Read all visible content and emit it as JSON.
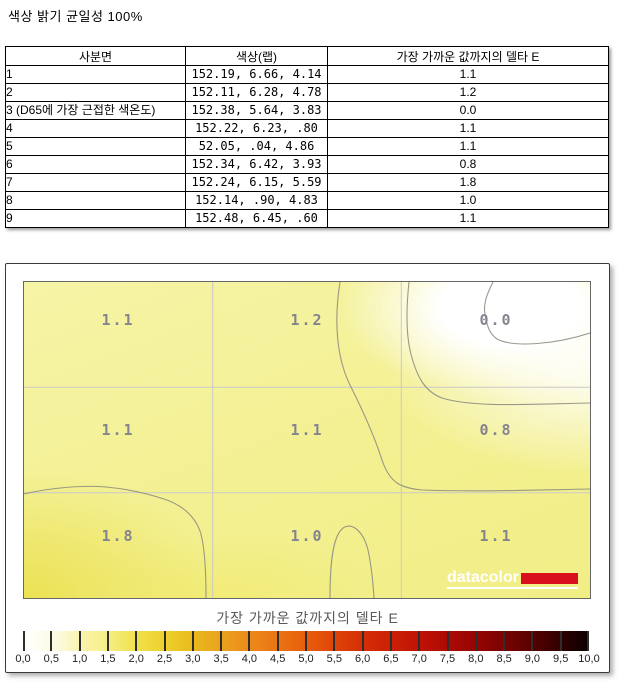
{
  "page": {
    "title": "색상 밝기 균일성 100%"
  },
  "table": {
    "headers": [
      "사분면",
      "색상(랩)",
      "가장 가까운 값까지의 델타 E"
    ],
    "rows": [
      {
        "quadrant": "1",
        "lab": "152.19,  6.66,  4.14",
        "delta_e": "1.1"
      },
      {
        "quadrant": "2",
        "lab": "152.11,  6.28,  4.78",
        "delta_e": "1.2"
      },
      {
        "quadrant": "3 (D65에 가장 근접한 색온도)",
        "lab": "152.38,  5.64,  3.83",
        "delta_e": "0.0"
      },
      {
        "quadrant": "4",
        "lab": "152.22,  6.23,   .80",
        "delta_e": "1.1"
      },
      {
        "quadrant": "5",
        "lab": " 52.05,   .04,  4.86",
        "delta_e": "1.1"
      },
      {
        "quadrant": "6",
        "lab": "152.34,  6.42,  3.93",
        "delta_e": "0.8"
      },
      {
        "quadrant": "7",
        "lab": "152.24,  6.15,  5.59",
        "delta_e": "1.8"
      },
      {
        "quadrant": "8",
        "lab": "152.14,   .90,  4.83",
        "delta_e": "1.0"
      },
      {
        "quadrant": "9",
        "lab": "152.48,  6.45,   .60",
        "delta_e": "1.1"
      }
    ]
  },
  "chart_data": {
    "type": "heatmap",
    "title": "가장 가까운 값까지의 델타 E",
    "rows": 3,
    "cols": 3,
    "values": [
      [
        1.1,
        1.2,
        0.0
      ],
      [
        1.1,
        1.1,
        0.8
      ],
      [
        1.8,
        1.0,
        1.1
      ]
    ],
    "cell_labels": [
      [
        "1.1",
        "1.2",
        "0.0"
      ],
      [
        "1.1",
        "1.1",
        "0.8"
      ],
      [
        "1.8",
        "1.0",
        "1.1"
      ]
    ],
    "colorbar": {
      "min": 0.0,
      "max": 10.0,
      "step": 0.5,
      "tick_labels": [
        "0,0",
        "0,5",
        "1,0",
        "1,5",
        "2,0",
        "2,5",
        "3,0",
        "3,5",
        "4,0",
        "4,5",
        "5,0",
        "5,5",
        "6,0",
        "6,5",
        "7,0",
        "7,5",
        "8,0",
        "8,5",
        "9,0",
        "9,5",
        "10,0"
      ],
      "low_color": "#ffffff",
      "mid_color": "#ec8a1c",
      "high_color": "#0a0000"
    },
    "grid_on": true,
    "legend_position": "bottom",
    "cell_base_color": "#f3f092",
    "hot_cell_color": "#ebe152",
    "logo": {
      "text": "datacolor",
      "accent_color": "#d90f1e"
    }
  }
}
